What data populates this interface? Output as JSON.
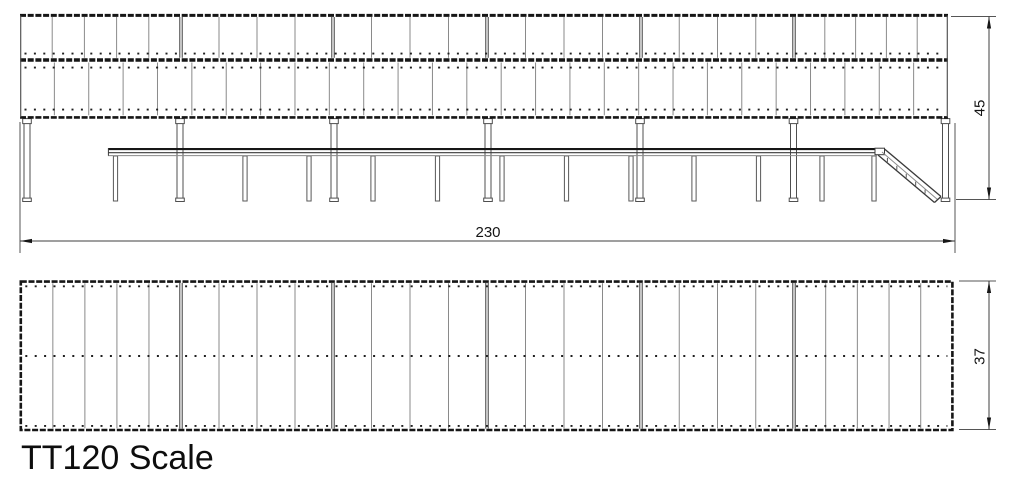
{
  "title": "TT120 Scale",
  "dimensions": {
    "length": "230",
    "height": "45",
    "depth": "37"
  },
  "drawing": {
    "colors": {
      "edge": "#161616",
      "panel": "#8a8a8a",
      "joint": "#3a3a3a",
      "outline": "#4f4f4f",
      "mid": "#3f3f3f",
      "dots": "#1f1f1f"
    },
    "elevation": {
      "x0": 20,
      "x1": 948,
      "roof_edge_y": 15.4,
      "divider_y": 60,
      "bottom_edge_y": 117.4,
      "upper_band": {
        "y0": 17,
        "y1": 57.8,
        "dot_y": 53.6
      },
      "lower_band": {
        "y0": 62.5,
        "y1": 115.3,
        "dot_rows": [
          67.6,
          109.6
        ],
        "panel_count": 27
      },
      "sections": [
        20,
        181,
        333,
        487,
        641,
        794,
        948
      ],
      "upper_panel_counts": [
        5,
        4,
        4,
        4,
        4,
        5
      ],
      "columns": [
        27,
        180,
        334,
        488,
        640,
        793.5,
        945.5
      ],
      "column": {
        "top": 119.5,
        "bottom": 201.5,
        "w": 6,
        "cap_w": 8.6,
        "cap_h": 5,
        "foot_w": 8.6,
        "foot_h": 3.4
      },
      "platform": {
        "x0": 108,
        "x1": 884,
        "top_y": 149.1,
        "mid_y": 152.7,
        "under_y": 155.6,
        "leg_top": 156,
        "leg_bottom": 201,
        "leg_w": 4.2,
        "legs": [
          115.5,
          245,
          309,
          373,
          437.5,
          502,
          566.5,
          631,
          694,
          758.5,
          822,
          874
        ]
      },
      "ramp": {
        "cap": [
          875,
          148.2,
          9.5,
          6.5
        ],
        "top": [
          884.5,
          149,
          941,
          196.5
        ],
        "bot": [
          878,
          155,
          934.5,
          202.5
        ],
        "ticks": 5
      }
    },
    "plan": {
      "x0": 20.8,
      "y0": 281.6,
      "x1": 952.4,
      "y1": 430,
      "sections": [
        20.8,
        181,
        333,
        487,
        641,
        794,
        952.4
      ],
      "panel_counts": [
        5,
        4,
        4,
        4,
        4,
        5
      ],
      "dot_rows": [
        286.3,
        356,
        425.9
      ]
    },
    "dims": {
      "length": {
        "ext": [
          [
            20,
            122,
            20,
            253
          ],
          [
            955,
            123,
            955,
            253
          ]
        ],
        "line": [
          20,
          241,
          955,
          241
        ],
        "vertical": false
      },
      "height": {
        "ext": [
          [
            951,
            16.5,
            996,
            16.5
          ],
          [
            956,
            199.5,
            996,
            199.5
          ]
        ],
        "line": [
          989,
          16.5,
          989,
          199.5
        ],
        "vertical": true
      },
      "depth": {
        "ext": [
          [
            959,
            281,
            996,
            281
          ],
          [
            959,
            429.5,
            996,
            429.5
          ]
        ],
        "line": [
          989,
          281,
          989,
          429.5
        ],
        "vertical": true
      }
    }
  }
}
